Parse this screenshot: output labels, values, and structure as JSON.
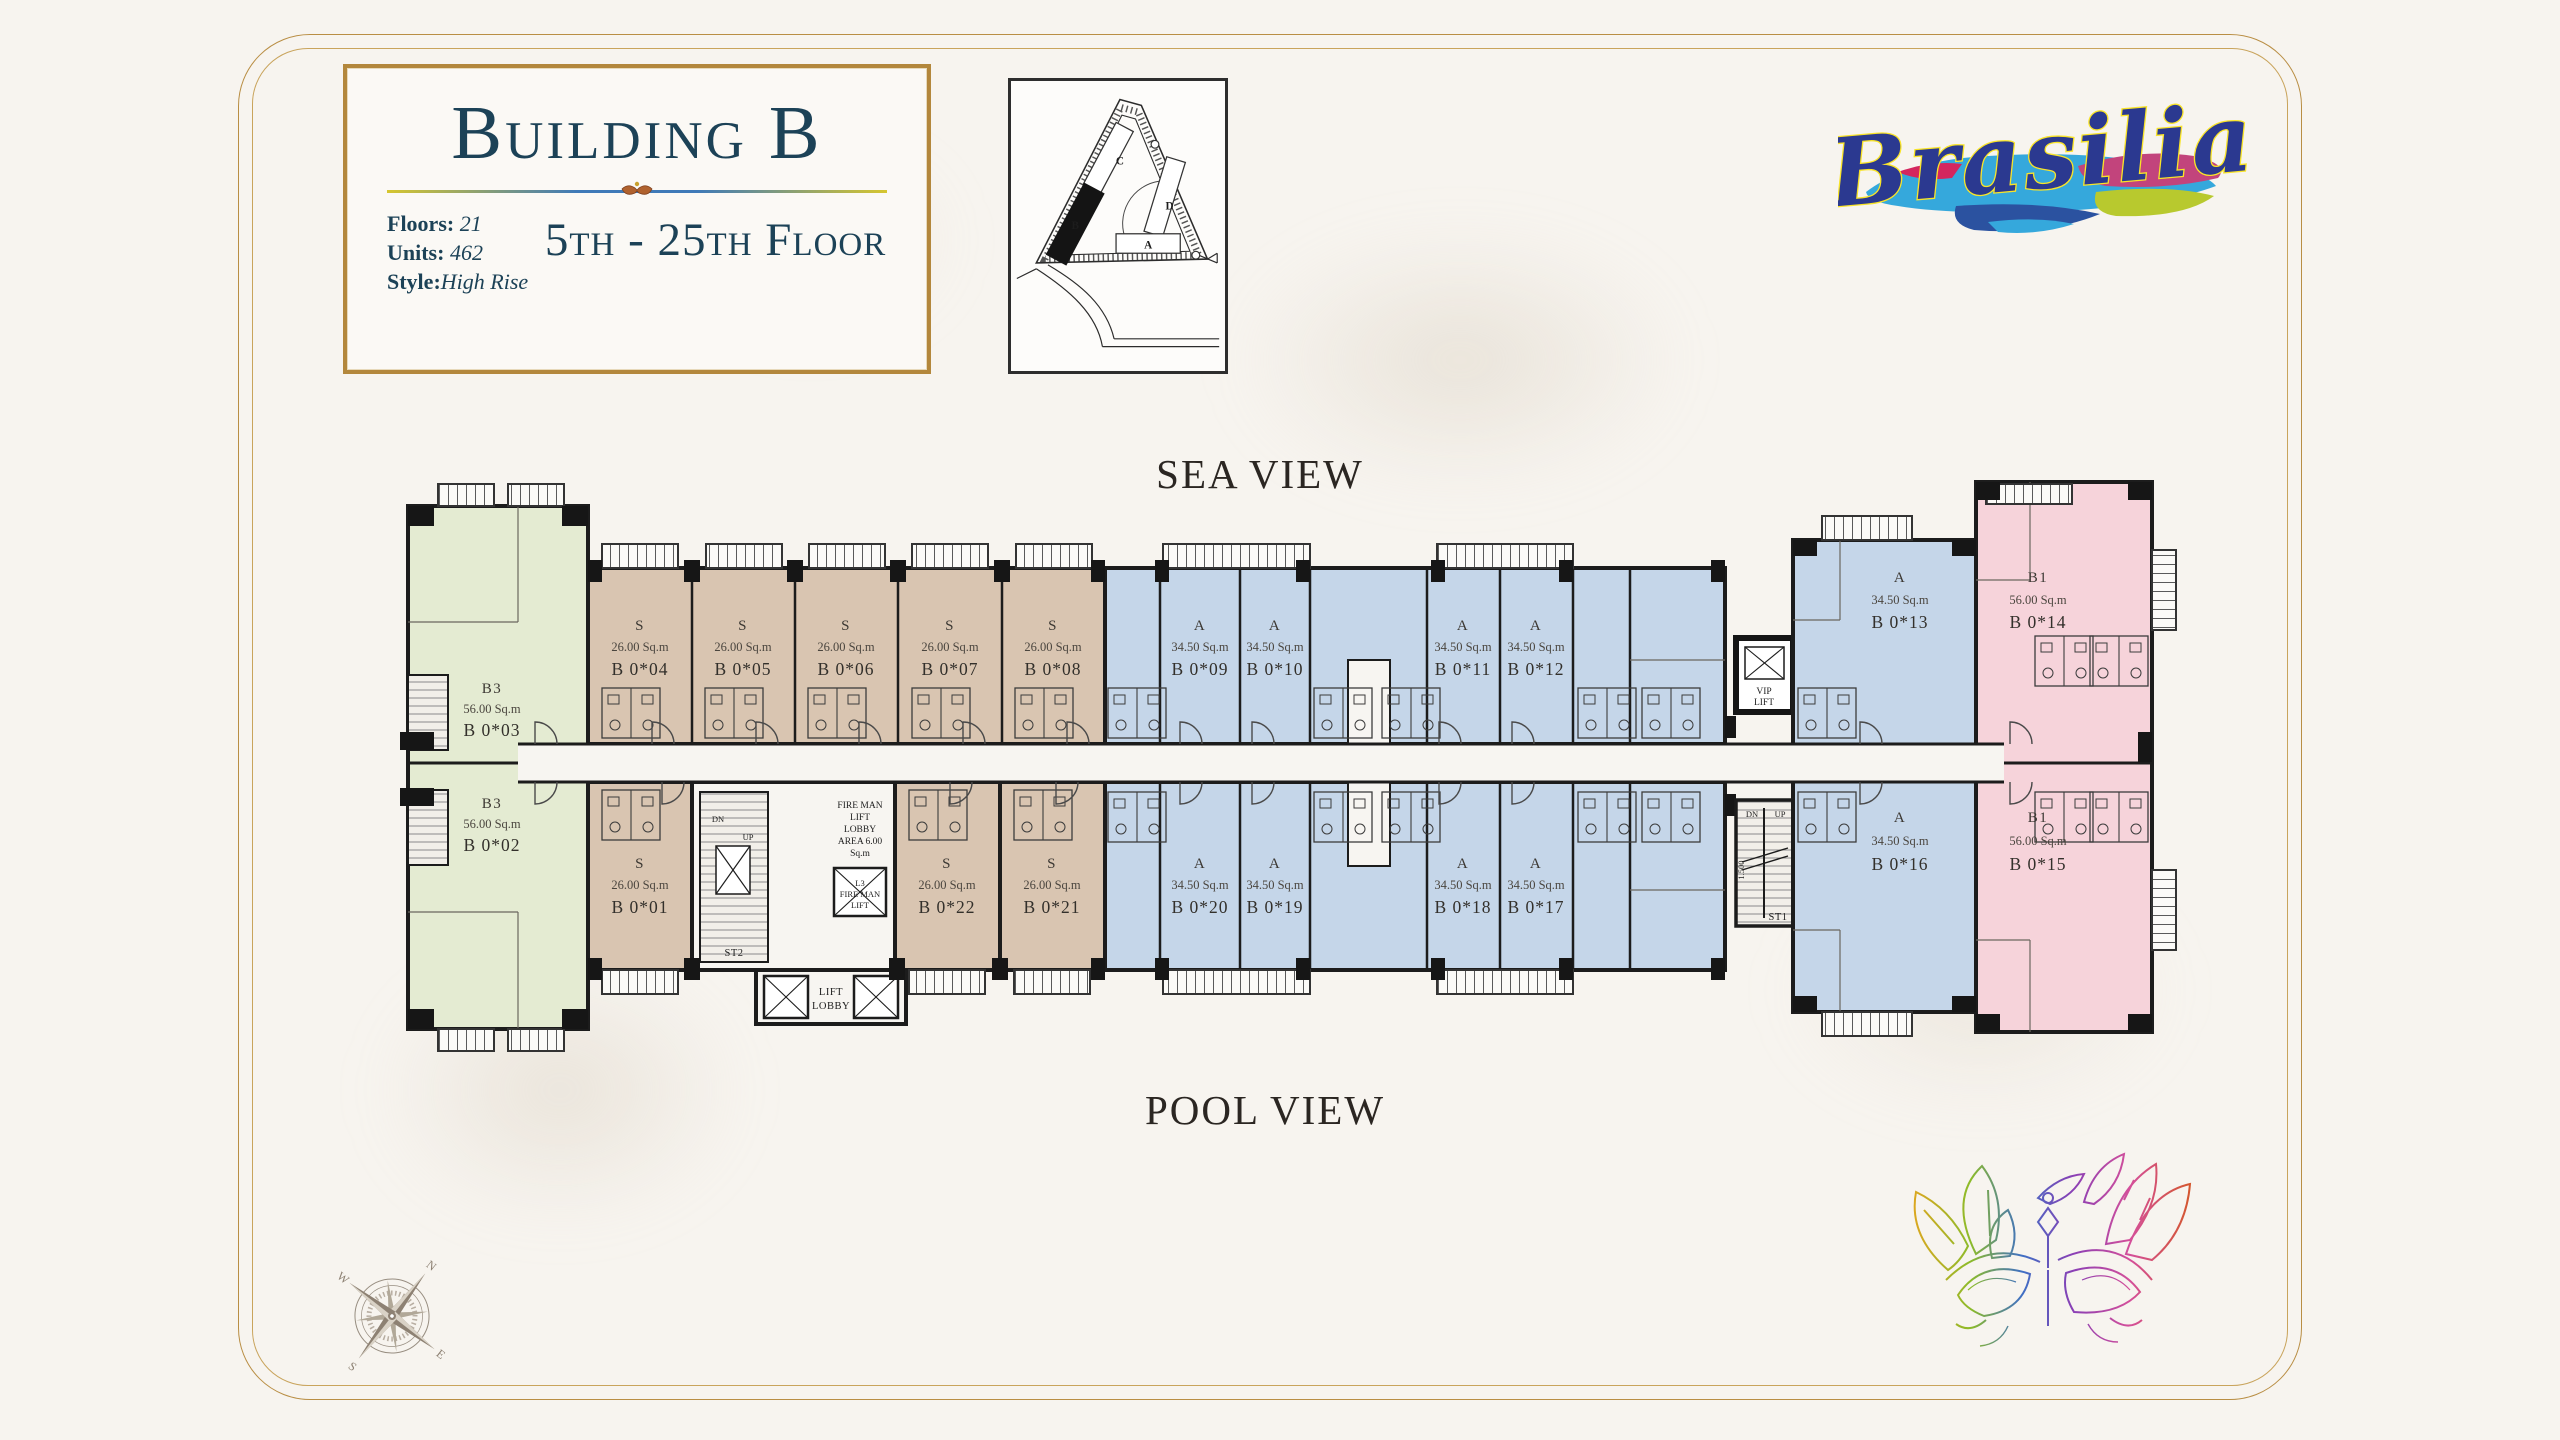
{
  "title_card": {
    "title": "Building B",
    "stats": [
      {
        "label": "Floors:",
        "value": "21"
      },
      {
        "label": "Units:",
        "value": "462"
      },
      {
        "label": "Style:",
        "value": "High Rise"
      }
    ],
    "floor_range": "5th - 25th Floor"
  },
  "logo": {
    "text": "Brasilia"
  },
  "site_map": {
    "labels": [
      "A",
      "B",
      "C",
      "D"
    ],
    "highlighted": "B"
  },
  "views": {
    "sea": "SEA VIEW",
    "pool": "POOL VIEW"
  },
  "compass": {
    "points": [
      "N",
      "E",
      "S",
      "W"
    ]
  },
  "plan": {
    "units": [
      {
        "type": "B3",
        "area": "56.00 Sq.m",
        "number": "B 0*03"
      },
      {
        "type": "B3",
        "area": "56.00 Sq.m",
        "number": "B 0*02"
      },
      {
        "type": "S",
        "area": "26.00 Sq.m",
        "number": "B 0*04"
      },
      {
        "type": "S",
        "area": "26.00 Sq.m",
        "number": "B 0*05"
      },
      {
        "type": "S",
        "area": "26.00 Sq.m",
        "number": "B 0*06"
      },
      {
        "type": "S",
        "area": "26.00 Sq.m",
        "number": "B 0*07"
      },
      {
        "type": "S",
        "area": "26.00 Sq.m",
        "number": "B 0*08"
      },
      {
        "type": "S",
        "area": "26.00 Sq.m",
        "number": "B 0*01"
      },
      {
        "type": "S",
        "area": "26.00 Sq.m",
        "number": "B 0*22"
      },
      {
        "type": "S",
        "area": "26.00 Sq.m",
        "number": "B 0*21"
      },
      {
        "type": "A",
        "area": "34.50 Sq.m",
        "number": "B 0*09"
      },
      {
        "type": "A",
        "area": "34.50 Sq.m",
        "number": "B 0*10"
      },
      {
        "type": "A",
        "area": "34.50 Sq.m",
        "number": "B 0*11"
      },
      {
        "type": "A",
        "area": "34.50 Sq.m",
        "number": "B 0*12"
      },
      {
        "type": "A",
        "area": "34.50 Sq.m",
        "number": "B 0*20"
      },
      {
        "type": "A",
        "area": "34.50 Sq.m",
        "number": "B 0*19"
      },
      {
        "type": "A",
        "area": "34.50 Sq.m",
        "number": "B 0*18"
      },
      {
        "type": "A",
        "area": "34.50 Sq.m",
        "number": "B 0*17"
      },
      {
        "type": "A",
        "area": "34.50 Sq.m",
        "number": "B 0*13"
      },
      {
        "type": "B1",
        "area": "56.00 Sq.m",
        "number": "B 0*14"
      },
      {
        "type": "A",
        "area": "34.50 Sq.m",
        "number": "B 0*16"
      },
      {
        "type": "B1",
        "area": "56.00 Sq.m",
        "number": "B 0*15"
      }
    ],
    "core": {
      "st2": "ST2",
      "st1": "ST1",
      "dn": "DN",
      "up": "UP",
      "dim": "1.500",
      "lift_lobby": [
        "LIFT",
        "LOBBY"
      ],
      "fireman_lobby": [
        "FIRE MAN",
        "LIFT",
        "LOBBY",
        "AREA 6.00",
        "Sq.m"
      ],
      "fireman_lift": [
        "L3",
        "FIRE MAN",
        "LIFT"
      ],
      "vip_lift": [
        "VIP",
        "LIFT"
      ]
    }
  },
  "colors": {
    "unit_b3": "#e4ebd2",
    "unit_s": "#d9c5b1",
    "unit_a": "#c5d6e9",
    "unit_b1": "#f6d3da",
    "wall": "#1c1c1c",
    "gold": "#b9913f",
    "navy": "#1c4257",
    "logo_blue": "#2b3990",
    "logo_outline": "#f9e428"
  }
}
